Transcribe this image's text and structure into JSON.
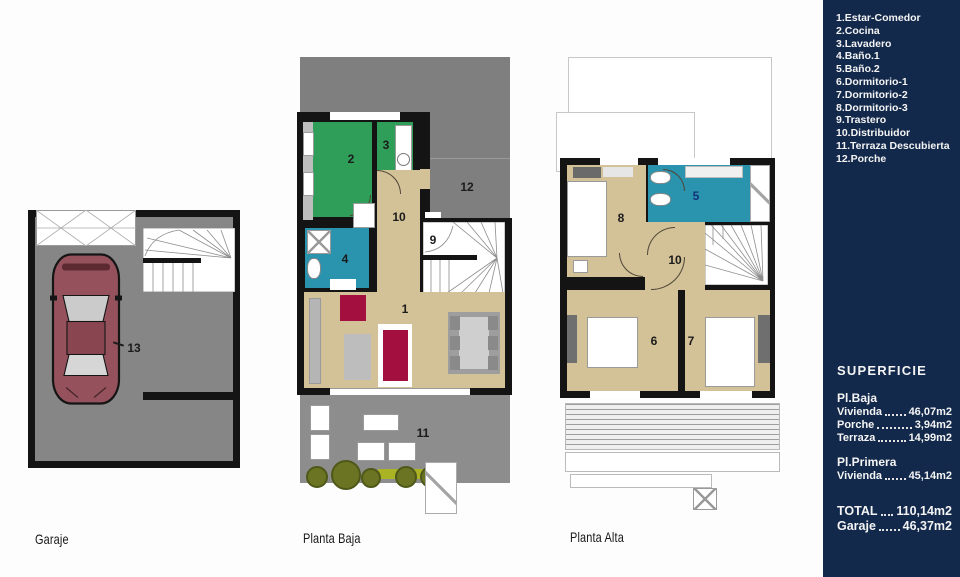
{
  "legend": {
    "items": [
      "1.Estar-Comedor",
      "2.Cocina",
      "3.Lavadero",
      "4.Baño.1",
      "5.Baño.2",
      "6.Dormitorio-1",
      "7.Dormitorio-2",
      "8.Dormitorio-3",
      "9.Trastero",
      "10.Distribuidor",
      "11.Terraza Descubierta",
      "12.Porche"
    ]
  },
  "superficie": {
    "title": "SUPERFICIE",
    "groups": [
      {
        "heading": "Pl.Baja",
        "rows": [
          {
            "name": "Vivienda",
            "value": "46,07m2"
          },
          {
            "name": "Porche",
            "value": "3,94m2"
          },
          {
            "name": "Terraza",
            "value": "14,99m2"
          }
        ]
      },
      {
        "heading": "Pl.Primera",
        "rows": [
          {
            "name": "Vivienda",
            "value": "45,14m2"
          }
        ]
      }
    ],
    "totals": [
      {
        "name": "TOTAL",
        "value": "110,14m2"
      },
      {
        "name": "Garaje",
        "value": "46,37m2"
      }
    ]
  },
  "plans": {
    "garaje": {
      "caption": "Garaje",
      "labels": {
        "car": "13"
      }
    },
    "planta_baja": {
      "caption": "Planta Baja",
      "labels": {
        "estar_comedor": "1",
        "cocina": "2",
        "lavadero": "3",
        "bano1": "4",
        "trastero": "9",
        "distribuidor": "10",
        "terraza": "11",
        "porche": "12"
      }
    },
    "planta_alta": {
      "caption": "Planta Alta",
      "labels": {
        "bano2": "5",
        "dormitorio1": "6",
        "dormitorio2": "7",
        "dormitorio3": "8",
        "distribuidor": "10"
      }
    }
  },
  "colors": {
    "sidebar_navy": "#13294b",
    "wall_black": "#141414",
    "floor_tan": "#d3c197",
    "room_green": "#2e9e58",
    "room_teal": "#2a93ad",
    "floor_gray": "#8a8a8a",
    "sofa_crimson": "#a30f3e",
    "car_maroon": "#96525c",
    "plant_olive": "#6a7422"
  }
}
